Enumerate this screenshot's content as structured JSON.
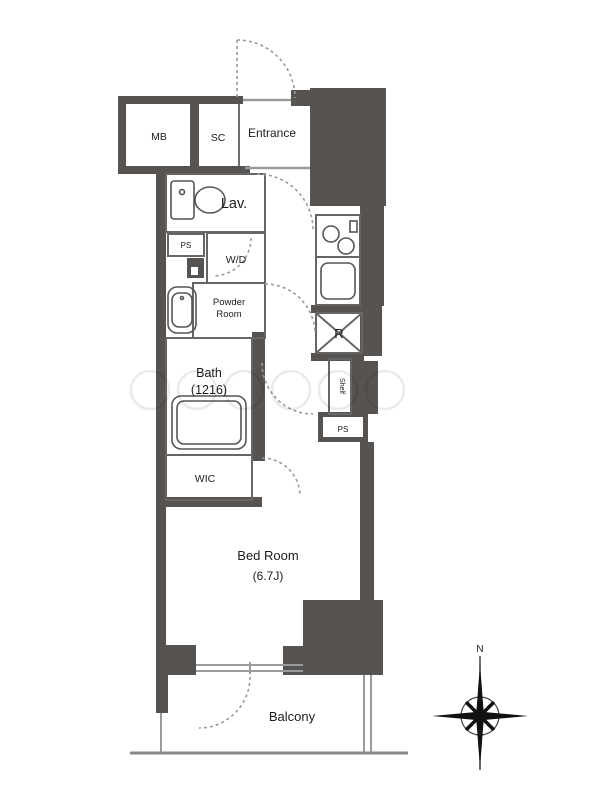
{
  "plan": {
    "type": "apartment-floor-plan",
    "rooms": {
      "mb": "MB",
      "sc": "SC",
      "entrance": "Entrance",
      "lav": "Lav.",
      "ps_upper": "PS",
      "wd": "W/D",
      "powder_line1": "Powder",
      "powder_line2": "Room",
      "bath_line1": "Bath",
      "bath_line2": "(1216)",
      "wic": "WIC",
      "fridge": "R",
      "shelf": "Shelf",
      "ps_lower": "PS",
      "bedroom_line1": "Bed Room",
      "bedroom_line2": "(6.7J)",
      "balcony": "Balcony"
    },
    "compass": {
      "north_label": "N"
    },
    "colors": {
      "wall": "#575350",
      "thin_line": "#666666",
      "dash_line": "#999999",
      "light_line": "#aaaaaa"
    }
  }
}
